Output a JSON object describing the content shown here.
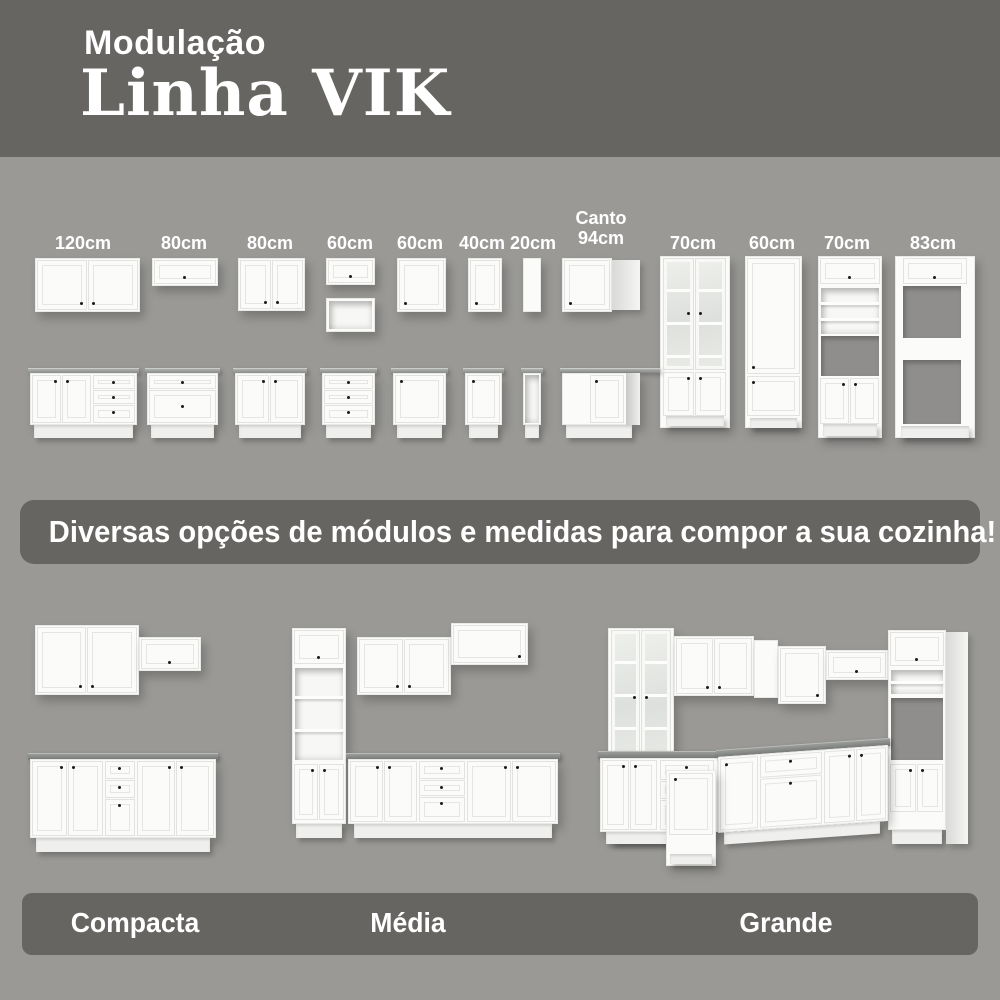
{
  "header": {
    "kicker": "Modulação",
    "title": "Linha VIK"
  },
  "modules": {
    "labels": [
      "120cm",
      "80cm",
      "80cm",
      "60cm",
      "60cm",
      "40cm",
      "20cm"
    ],
    "corner_label": {
      "line1": "Canto",
      "line2": "94cm"
    },
    "tower_labels": [
      "70cm",
      "60cm",
      "70cm",
      "83cm"
    ]
  },
  "banner": {
    "text": "Diversas opções de módulos e medidas para compor a sua cozinha!"
  },
  "kitchens": [
    {
      "label": "Compacta"
    },
    {
      "label": "Média"
    },
    {
      "label": "Grande"
    }
  ],
  "colors": {
    "background": "#9a9996",
    "band": "#676561",
    "cabinet_white": "#fbfbf9",
    "countertop": "#8e908e",
    "text": "#ffffff"
  }
}
